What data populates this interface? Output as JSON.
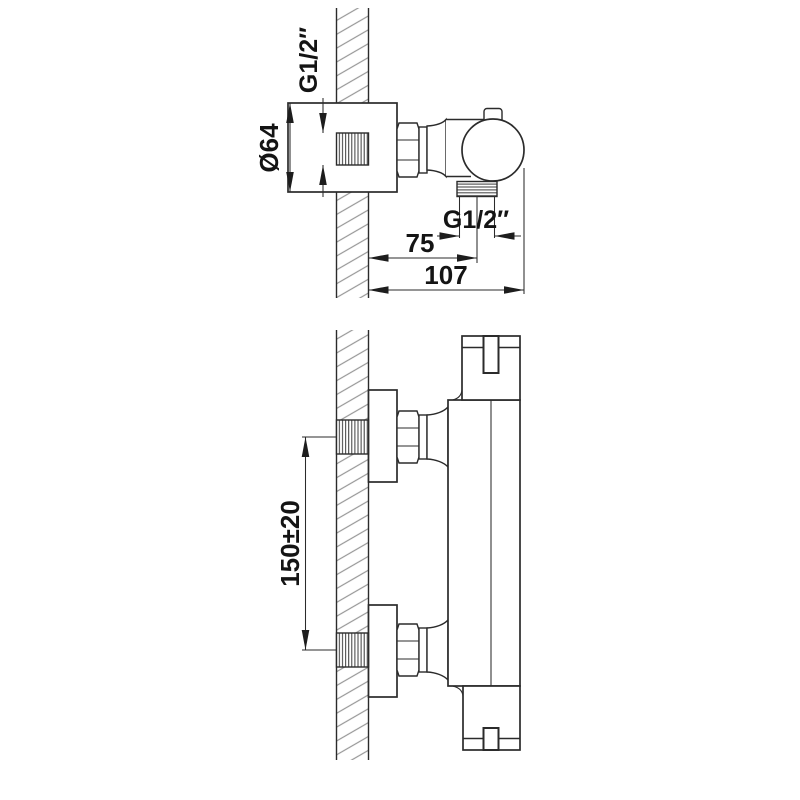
{
  "colors": {
    "background": "#ffffff",
    "line": "#2b2b2b",
    "hatch": "#979797",
    "text": "#141414"
  },
  "views": {
    "side": {
      "dims": {
        "inlet_thread": "G1/2″",
        "plate_diameter": "Ø64",
        "outlet_thread": "G1/2″",
        "wall_to_outlet": "75",
        "wall_to_front": "107"
      }
    },
    "front": {
      "dims": {
        "inlet_spacing": "150±20"
      }
    }
  }
}
